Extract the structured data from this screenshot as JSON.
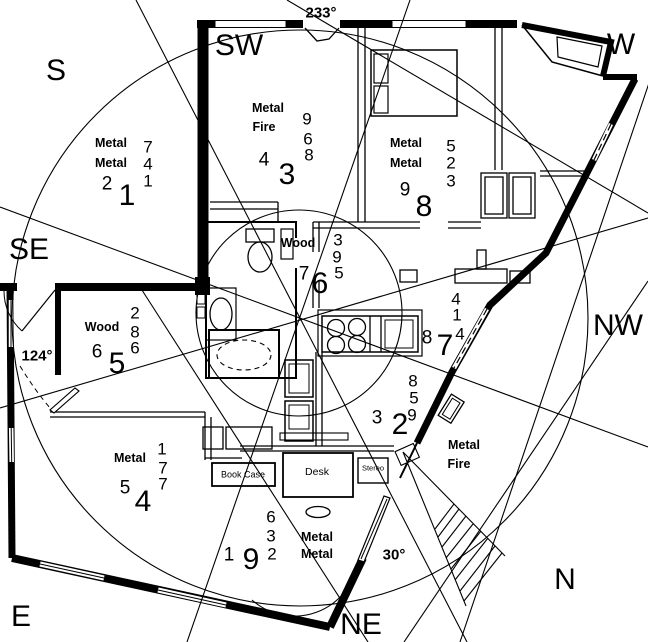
{
  "ink_color": "#000000",
  "paper_color": "#ffffff",
  "compass_labels": [
    {
      "id": "s",
      "text": "S",
      "x": 56,
      "y": 71
    },
    {
      "id": "sw",
      "text": "SW",
      "x": 239,
      "y": 46
    },
    {
      "id": "w",
      "text": "W",
      "x": 621,
      "y": 45
    },
    {
      "id": "se",
      "text": "SE",
      "x": 29,
      "y": 250
    },
    {
      "id": "nw",
      "text": "NW",
      "x": 618,
      "y": 326
    },
    {
      "id": "e",
      "text": "E",
      "x": 21,
      "y": 617
    },
    {
      "id": "ne",
      "text": "NE",
      "x": 361,
      "y": 625
    },
    {
      "id": "n",
      "text": "N",
      "x": 565,
      "y": 580
    }
  ],
  "degree_labels": [
    {
      "id": "233",
      "text": "233°",
      "x": 321,
      "y": 13
    },
    {
      "id": "124",
      "text": "124°",
      "x": 37,
      "y": 356
    },
    {
      "id": "30",
      "text": "30°",
      "x": 394,
      "y": 555
    }
  ],
  "sectors": [
    {
      "id": "sector-s",
      "element_labels": [
        {
          "text": "Metal",
          "x": 111,
          "y": 143
        },
        {
          "text": "Metal",
          "x": 111,
          "y": 163
        }
      ],
      "stack": [
        {
          "text": "7",
          "x": 148,
          "y": 147
        },
        {
          "text": "4",
          "x": 148,
          "y": 164
        },
        {
          "text": "1",
          "x": 148,
          "y": 181
        }
      ],
      "secondary": {
        "text": "2",
        "x": 107,
        "y": 184
      },
      "primary": {
        "text": "1",
        "x": 127,
        "y": 196
      }
    },
    {
      "id": "sector-sw",
      "element_labels": [
        {
          "text": "Metal",
          "x": 268,
          "y": 108
        },
        {
          "text": "Fire",
          "x": 264,
          "y": 127
        }
      ],
      "stack": [
        {
          "text": "9",
          "x": 307,
          "y": 119
        },
        {
          "text": "6",
          "x": 308,
          "y": 139
        },
        {
          "text": "8",
          "x": 309,
          "y": 155
        }
      ],
      "secondary": {
        "text": "4",
        "x": 264,
        "y": 160
      },
      "primary": {
        "text": "3",
        "x": 287,
        "y": 175
      }
    },
    {
      "id": "sector-w",
      "element_labels": [
        {
          "text": "Metal",
          "x": 406,
          "y": 143
        },
        {
          "text": "Metal",
          "x": 406,
          "y": 163
        }
      ],
      "stack": [
        {
          "text": "5",
          "x": 451,
          "y": 146
        },
        {
          "text": "2",
          "x": 451,
          "y": 163
        },
        {
          "text": "3",
          "x": 451,
          "y": 181
        }
      ],
      "secondary": {
        "text": "9",
        "x": 405,
        "y": 190
      },
      "primary": {
        "text": "8",
        "x": 424,
        "y": 207
      }
    },
    {
      "id": "sector-center",
      "element_labels": [
        {
          "text": "Wood",
          "x": 298,
          "y": 243
        }
      ],
      "stack": [
        {
          "text": "3",
          "x": 338,
          "y": 240
        },
        {
          "text": "9",
          "x": 337,
          "y": 257
        },
        {
          "text": "5",
          "x": 339,
          "y": 273
        }
      ],
      "secondary": {
        "text": "7",
        "x": 304,
        "y": 274
      },
      "primary": {
        "text": "6",
        "x": 320,
        "y": 284
      }
    },
    {
      "id": "sector-se",
      "element_labels": [
        {
          "text": "Wood",
          "x": 102,
          "y": 327
        }
      ],
      "stack": [
        {
          "text": "2",
          "x": 135,
          "y": 313
        },
        {
          "text": "8",
          "x": 135,
          "y": 332
        },
        {
          "text": "6",
          "x": 135,
          "y": 348
        }
      ],
      "secondary": {
        "text": "6",
        "x": 97,
        "y": 352
      },
      "primary": {
        "text": "5",
        "x": 117,
        "y": 364
      }
    },
    {
      "id": "sector-nw",
      "element_labels": [],
      "stack": [
        {
          "text": "4",
          "x": 456,
          "y": 299
        },
        {
          "text": "1",
          "x": 457,
          "y": 315
        },
        {
          "text": "4",
          "x": 460,
          "y": 334
        }
      ],
      "secondary": {
        "text": "8",
        "x": 427,
        "y": 338
      },
      "primary": {
        "text": "7",
        "x": 445,
        "y": 346
      }
    },
    {
      "id": "sector-ne-inner",
      "element_labels": [],
      "stack": [
        {
          "text": "8",
          "x": 413,
          "y": 381
        },
        {
          "text": "5",
          "x": 414,
          "y": 398
        },
        {
          "text": "9",
          "x": 412,
          "y": 415
        }
      ],
      "secondary": {
        "text": "3",
        "x": 377,
        "y": 418
      },
      "primary": {
        "text": "2",
        "x": 400,
        "y": 425
      }
    },
    {
      "id": "sector-e",
      "element_labels": [
        {
          "text": "Metal",
          "x": 130,
          "y": 458
        }
      ],
      "stack": [
        {
          "text": "1",
          "x": 162,
          "y": 449
        },
        {
          "text": "7",
          "x": 163,
          "y": 468
        },
        {
          "text": "7",
          "x": 163,
          "y": 484
        }
      ],
      "secondary": {
        "text": "5",
        "x": 125,
        "y": 488
      },
      "primary": {
        "text": "4",
        "x": 143,
        "y": 502
      }
    },
    {
      "id": "sector-n",
      "element_labels": [
        {
          "text": "Metal",
          "x": 317,
          "y": 537
        },
        {
          "text": "Metal",
          "x": 317,
          "y": 554
        }
      ],
      "stack": [
        {
          "text": "6",
          "x": 271,
          "y": 517
        },
        {
          "text": "3",
          "x": 271,
          "y": 536
        },
        {
          "text": "2",
          "x": 272,
          "y": 554
        }
      ],
      "secondary": {
        "text": "1",
        "x": 229,
        "y": 555
      },
      "primary": {
        "text": "9",
        "x": 251,
        "y": 560
      }
    },
    {
      "id": "sector-nw-outer",
      "element_labels": [
        {
          "text": "Metal",
          "x": 464,
          "y": 445
        },
        {
          "text": "Fire",
          "x": 459,
          "y": 464
        }
      ],
      "stack": [],
      "secondary": null,
      "primary": null
    }
  ],
  "furniture": {
    "book_case": {
      "label": "Book Case"
    },
    "desk": {
      "label": "Desk"
    },
    "stereo": {
      "label": "Stereo"
    }
  }
}
